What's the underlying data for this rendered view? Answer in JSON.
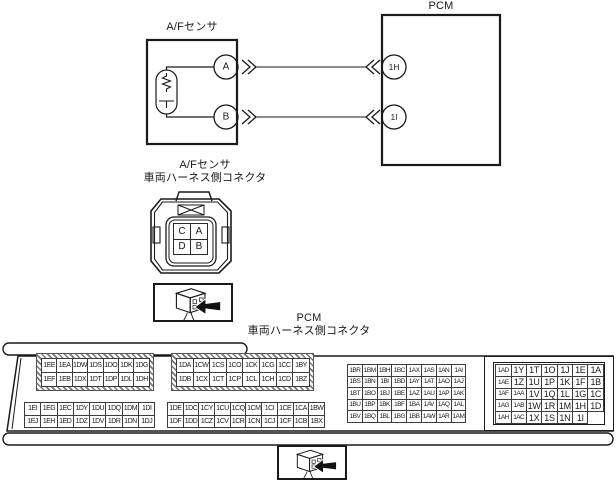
{
  "top_diagram": {
    "sensor_label": "A/Fセンサ",
    "pcm_label": "PCM",
    "sensor_pin_a": "A",
    "sensor_pin_b": "B",
    "pcm_pin_1": "1H",
    "pcm_pin_2": "1I"
  },
  "sensor_connector": {
    "label_line1": "A/Fセンサ",
    "label_line2": "車両ハーネス側コネクタ",
    "pins": [
      [
        "C",
        "A"
      ],
      [
        "D",
        "B"
      ]
    ]
  },
  "pcm_connector": {
    "label_line1": "PCM",
    "label_line2": "車両ハーネス側コネクタ",
    "blocks": {
      "upper_left": [
        [
          "1EE",
          "1EA",
          "1DW",
          "1DS",
          "1DO",
          "1DK",
          "1DG"
        ],
        [
          "1EF",
          "1EB",
          "1DX",
          "1DT",
          "1DP",
          "1DL",
          "1DH"
        ]
      ],
      "upper_mid": [
        [
          "1DA",
          "1CW",
          "1CS",
          "1CO",
          "1CK",
          "1CG",
          "1CC",
          "1BY"
        ],
        [
          "1DB",
          "1CX",
          "1CT",
          "1CP",
          "1CL",
          "1CH",
          "1CD",
          "1BZ"
        ]
      ],
      "right_mid": [
        [
          "1BR",
          "1BM",
          "1BH",
          "1BC",
          "1AX",
          "1AS",
          "1AN",
          "1AI"
        ],
        [
          "1BS",
          "1BN",
          "1BI",
          "1BD",
          "1AY",
          "1AT",
          "1AO",
          "1AJ"
        ],
        [
          "1BT",
          "1BO",
          "1BJ",
          "1BE",
          "1AZ",
          "1AU",
          "1AP",
          "1AK"
        ],
        [
          "1BU",
          "1BP",
          "1BK",
          "1BF",
          "1BA",
          "1AV",
          "1AQ",
          "1AL"
        ],
        [
          "1BV",
          "1BQ",
          "1BL",
          "1BG",
          "1BB",
          "1AW",
          "1AR",
          "1AM"
        ]
      ],
      "far_right": [
        [
          "1AD",
          "1Y",
          "1T",
          "1O",
          "1J",
          "1E",
          "1A"
        ],
        [
          "1AE",
          "1Z",
          "1U",
          "1P",
          "1K",
          "1F",
          "1B"
        ],
        [
          "1AF",
          "1AA",
          "1V",
          "1Q",
          "1L",
          "1G",
          "1C"
        ],
        [
          "1AG",
          "1AB",
          "1W",
          "1R",
          "1M",
          "1H",
          "1D"
        ],
        [
          "1AH",
          "1AC",
          "1X",
          "1S",
          "1N",
          "1I"
        ]
      ],
      "lower_left": [
        [
          "1EI",
          "1EG",
          "1EC",
          "1DY",
          "1DU",
          "1DQ",
          "1DM",
          "1DI"
        ],
        [
          "1EJ",
          "1EH",
          "1ED",
          "1DZ",
          "1DV",
          "1DR",
          "1DN",
          "1DJ"
        ]
      ],
      "lower_mid": [
        [
          "1DE",
          "1DC",
          "1CY",
          "1CU",
          "1CQ",
          "1CM",
          "1CI",
          "1CE",
          "1CA",
          "1BW"
        ],
        [
          "1DF",
          "1DD",
          "1CZ",
          "1CV",
          "1CR",
          "1CN",
          "1CJ",
          "1CF",
          "1CB",
          "1BX"
        ]
      ]
    }
  }
}
